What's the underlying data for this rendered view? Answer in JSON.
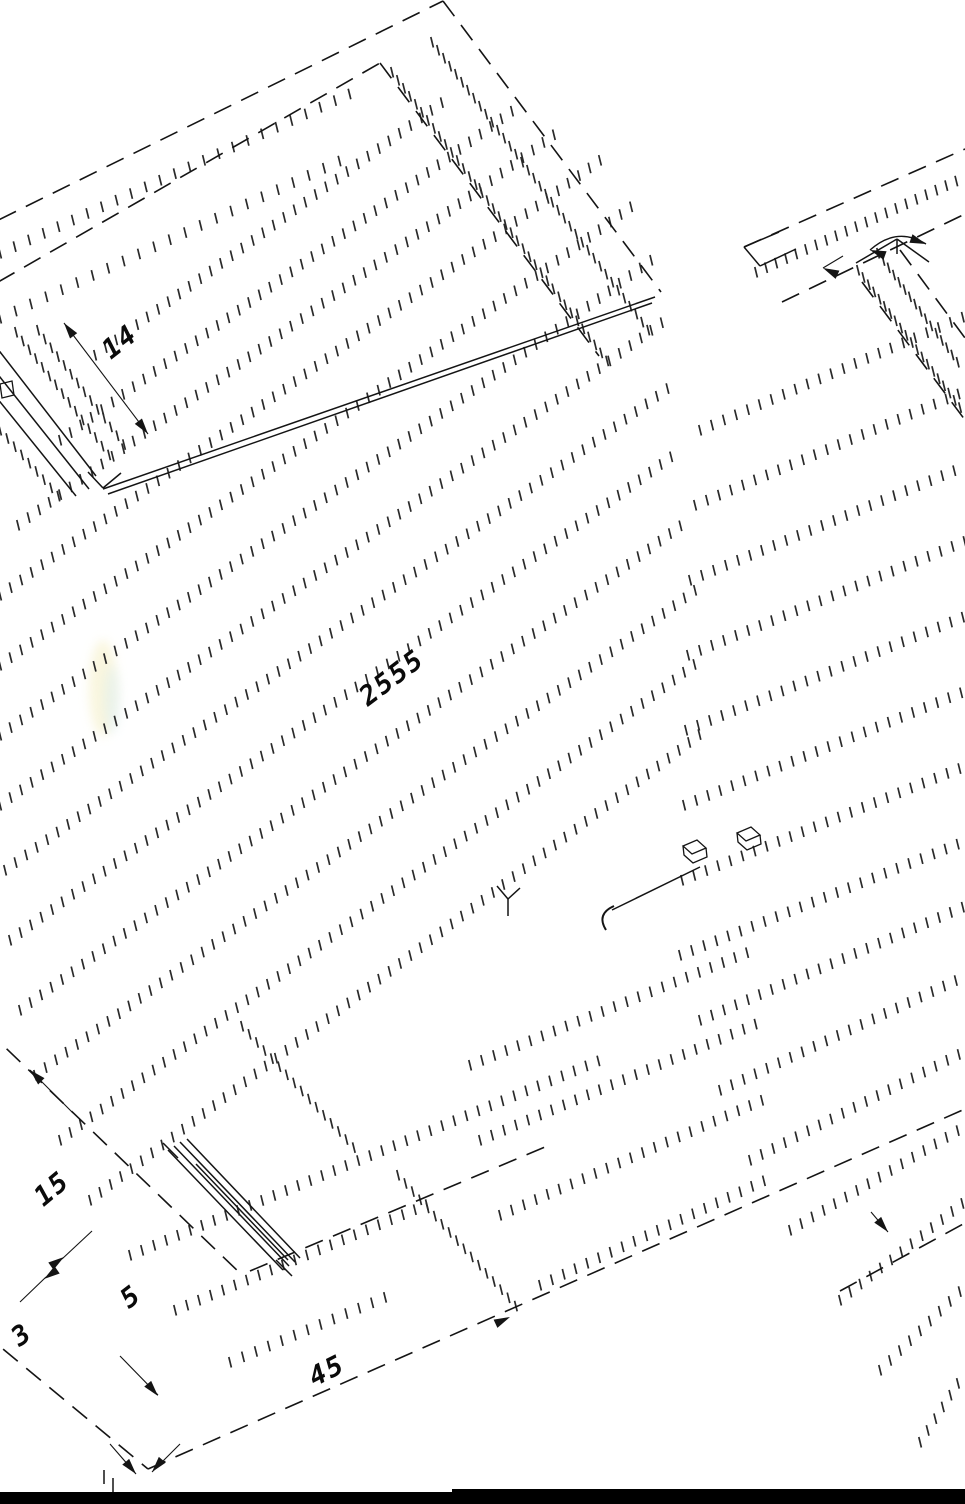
{
  "labels": [
    {
      "text": "14",
      "x": 120,
      "y": 342,
      "rot": -38
    },
    {
      "text": "2555",
      "x": 392,
      "y": 678,
      "rot": -37
    },
    {
      "text": "15",
      "x": 52,
      "y": 1189,
      "rot": -40
    },
    {
      "text": "5",
      "x": 131,
      "y": 1297,
      "rot": -37
    },
    {
      "text": "3",
      "x": 22,
      "y": 1335,
      "rot": -36
    },
    {
      "text": "45",
      "x": 327,
      "y": 1371,
      "rot": -27
    }
  ],
  "drawing": {
    "canvas": {
      "w": 965,
      "h": 1504,
      "bg": "#ffffff",
      "ink": "#141414",
      "hatch": "#2a2a2a"
    },
    "dashed_lines": [
      [
        -28,
        233,
        443,
        1
      ],
      [
        443,
        1,
        661,
        292
      ],
      [
        -28,
        297,
        380,
        63
      ],
      [
        380,
        63,
        599,
        356
      ],
      [
        744,
        247,
        965,
        149
      ],
      [
        782,
        302,
        965,
        214
      ],
      [
        862,
        282,
        965,
        420
      ],
      [
        900,
        250,
        965,
        338
      ],
      [
        -20,
        1330,
        148,
        1469
      ],
      [
        148,
        1469,
        965,
        1109
      ],
      [
        -15,
        1028,
        243,
        1276
      ],
      [
        250,
        1271,
        545,
        1147
      ],
      [
        840,
        1291,
        965,
        1223
      ]
    ],
    "solid_lines": [
      [
        -20,
        326,
        96,
        476
      ],
      [
        -20,
        352,
        89,
        489
      ],
      [
        -20,
        377,
        76,
        496
      ],
      [
        88,
        472,
        103,
        488
      ],
      [
        103,
        488,
        121,
        473
      ],
      [
        103,
        489,
        655,
        297
      ],
      [
        108,
        494,
        652,
        303
      ],
      [
        744,
        247,
        760,
        266
      ],
      [
        744,
        247,
        779,
        232
      ],
      [
        760,
        266,
        796,
        249
      ],
      [
        856,
        263,
        897,
        239
      ],
      [
        897,
        239,
        929,
        262
      ],
      [
        897,
        239,
        897,
        254
      ],
      [
        497,
        886,
        508,
        899
      ],
      [
        508,
        899,
        520,
        888
      ],
      [
        508,
        899,
        508,
        916
      ],
      [
        168,
        1150,
        283,
        1270
      ],
      [
        174,
        1146,
        289,
        1266
      ],
      [
        180,
        1142,
        295,
        1262
      ],
      [
        187,
        1139,
        300,
        1258
      ],
      [
        196,
        1164,
        288,
        1260
      ],
      [
        163,
        1143,
        178,
        1158
      ],
      [
        276,
        1260,
        292,
        1276
      ],
      [
        612,
        910,
        700,
        867
      ],
      [
        113,
        1478,
        113,
        1497
      ],
      [
        104,
        1470,
        104,
        1484
      ]
    ],
    "thin_lines": [
      [
        64,
        323,
        148,
        434
      ],
      [
        823,
        268,
        843,
        256
      ],
      [
        30,
        1070,
        73,
        1113
      ],
      [
        62,
        1259,
        92,
        1231
      ],
      [
        46,
        1277,
        20,
        1302
      ],
      [
        120,
        1356,
        158,
        1395
      ],
      [
        871,
        1212,
        888,
        1232
      ],
      [
        110,
        1444,
        136,
        1474
      ],
      [
        180,
        1444,
        152,
        1472
      ]
    ],
    "arrows": [
      [
        64,
        323,
        -127
      ],
      [
        148,
        434,
        53
      ],
      [
        823,
        268,
        -155
      ],
      [
        870,
        250,
        -160
      ],
      [
        926,
        244,
        20
      ],
      [
        30,
        1070,
        -135
      ],
      [
        64,
        1257,
        -35
      ],
      [
        44,
        1279,
        145
      ],
      [
        158,
        1396,
        50
      ],
      [
        136,
        1474,
        50
      ],
      [
        152,
        1472,
        130
      ],
      [
        888,
        1232,
        50
      ],
      [
        510,
        1317,
        -25
      ]
    ],
    "paths": [
      {
        "d": "M 870,250 Q 897,226 926,244",
        "sw": 1.4
      },
      {
        "d": "M 614,906 q -18,8 -8,24",
        "sw": 2
      },
      {
        "d": "M 0,384 L 12,381 L 14,395 L 2,398 Z",
        "sw": 1.3
      },
      {
        "d": "M683,846l14,-6l9,8l-14,6zM683,846l1,9l9,8l14,-6l-1,-9",
        "sw": 1.3
      },
      {
        "d": "M737,833l14,-6l9,8l-14,6zM737,833l1,9l9,8l14,-6l-1,-9",
        "sw": 1.3
      }
    ],
    "hatch_rows": [
      [
        95,
        355,
        445,
        100,
        13
      ],
      [
        60,
        440,
        520,
        105,
        13
      ],
      [
        18,
        525,
        560,
        130,
        13
      ],
      [
        0,
        595,
        600,
        160,
        13
      ],
      [
        0,
        665,
        640,
        200,
        13
      ],
      [
        0,
        735,
        658,
        255,
        13
      ],
      [
        0,
        805,
        665,
        320,
        13
      ],
      [
        5,
        870,
        672,
        385,
        13
      ],
      [
        10,
        940,
        680,
        450,
        13
      ],
      [
        20,
        1010,
        688,
        520,
        13
      ],
      [
        35,
        1075,
        695,
        590,
        13
      ],
      [
        60,
        1140,
        700,
        660,
        13
      ],
      [
        90,
        1200,
        705,
        730,
        13
      ],
      [
        130,
        1255,
        600,
        1060,
        13
      ],
      [
        175,
        1310,
        430,
        1203,
        13
      ],
      [
        230,
        1362,
        390,
        1295,
        14
      ],
      [
        392,
        72,
        608,
        362,
        10
      ],
      [
        432,
        42,
        652,
        335,
        10
      ],
      [
        0,
        253,
        362,
        88,
        16
      ],
      [
        0,
        318,
        352,
        155,
        17
      ],
      [
        16,
        332,
        110,
        456,
        11
      ],
      [
        38,
        330,
        126,
        447,
        11
      ],
      [
        0,
        430,
        62,
        500,
        11
      ],
      [
        700,
        430,
        965,
        316,
        13
      ],
      [
        695,
        505,
        965,
        391,
        13
      ],
      [
        690,
        580,
        965,
        466,
        13
      ],
      [
        688,
        655,
        965,
        541,
        13
      ],
      [
        686,
        730,
        965,
        616,
        13
      ],
      [
        684,
        805,
        965,
        691,
        13
      ],
      [
        682,
        880,
        965,
        766,
        13
      ],
      [
        680,
        955,
        965,
        841,
        13
      ],
      [
        700,
        1020,
        965,
        906,
        13
      ],
      [
        720,
        1090,
        965,
        976,
        13
      ],
      [
        750,
        1160,
        965,
        1051,
        13
      ],
      [
        790,
        1230,
        965,
        1126,
        13
      ],
      [
        840,
        1300,
        965,
        1201,
        13
      ],
      [
        880,
        1370,
        965,
        1286,
        14
      ],
      [
        920,
        1442,
        965,
        1372,
        14
      ],
      [
        858,
        270,
        962,
        410,
        9
      ],
      [
        878,
        253,
        962,
        368,
        9
      ],
      [
        756,
        272,
        958,
        180,
        11
      ],
      [
        470,
        1065,
        758,
        948,
        13
      ],
      [
        480,
        1140,
        760,
        1022,
        13
      ],
      [
        500,
        1215,
        762,
        1100,
        13
      ],
      [
        540,
        1285,
        765,
        1180,
        13
      ],
      [
        242,
        1026,
        358,
        1152,
        11
      ],
      [
        398,
        1175,
        516,
        1306,
        11
      ]
    ],
    "smudges": [
      {
        "cx": 103,
        "cy": 688,
        "rx": 14,
        "ry": 48,
        "fill": "#f5efc4",
        "op": 0.55
      },
      {
        "cx": 112,
        "cy": 700,
        "rx": 8,
        "ry": 34,
        "fill": "#d9edf2",
        "op": 0.45
      }
    ],
    "bars": [
      {
        "x": 0,
        "y": 1492,
        "w": 452,
        "h": 12
      },
      {
        "x": 452,
        "y": 1489,
        "w": 513,
        "h": 15
      }
    ]
  }
}
